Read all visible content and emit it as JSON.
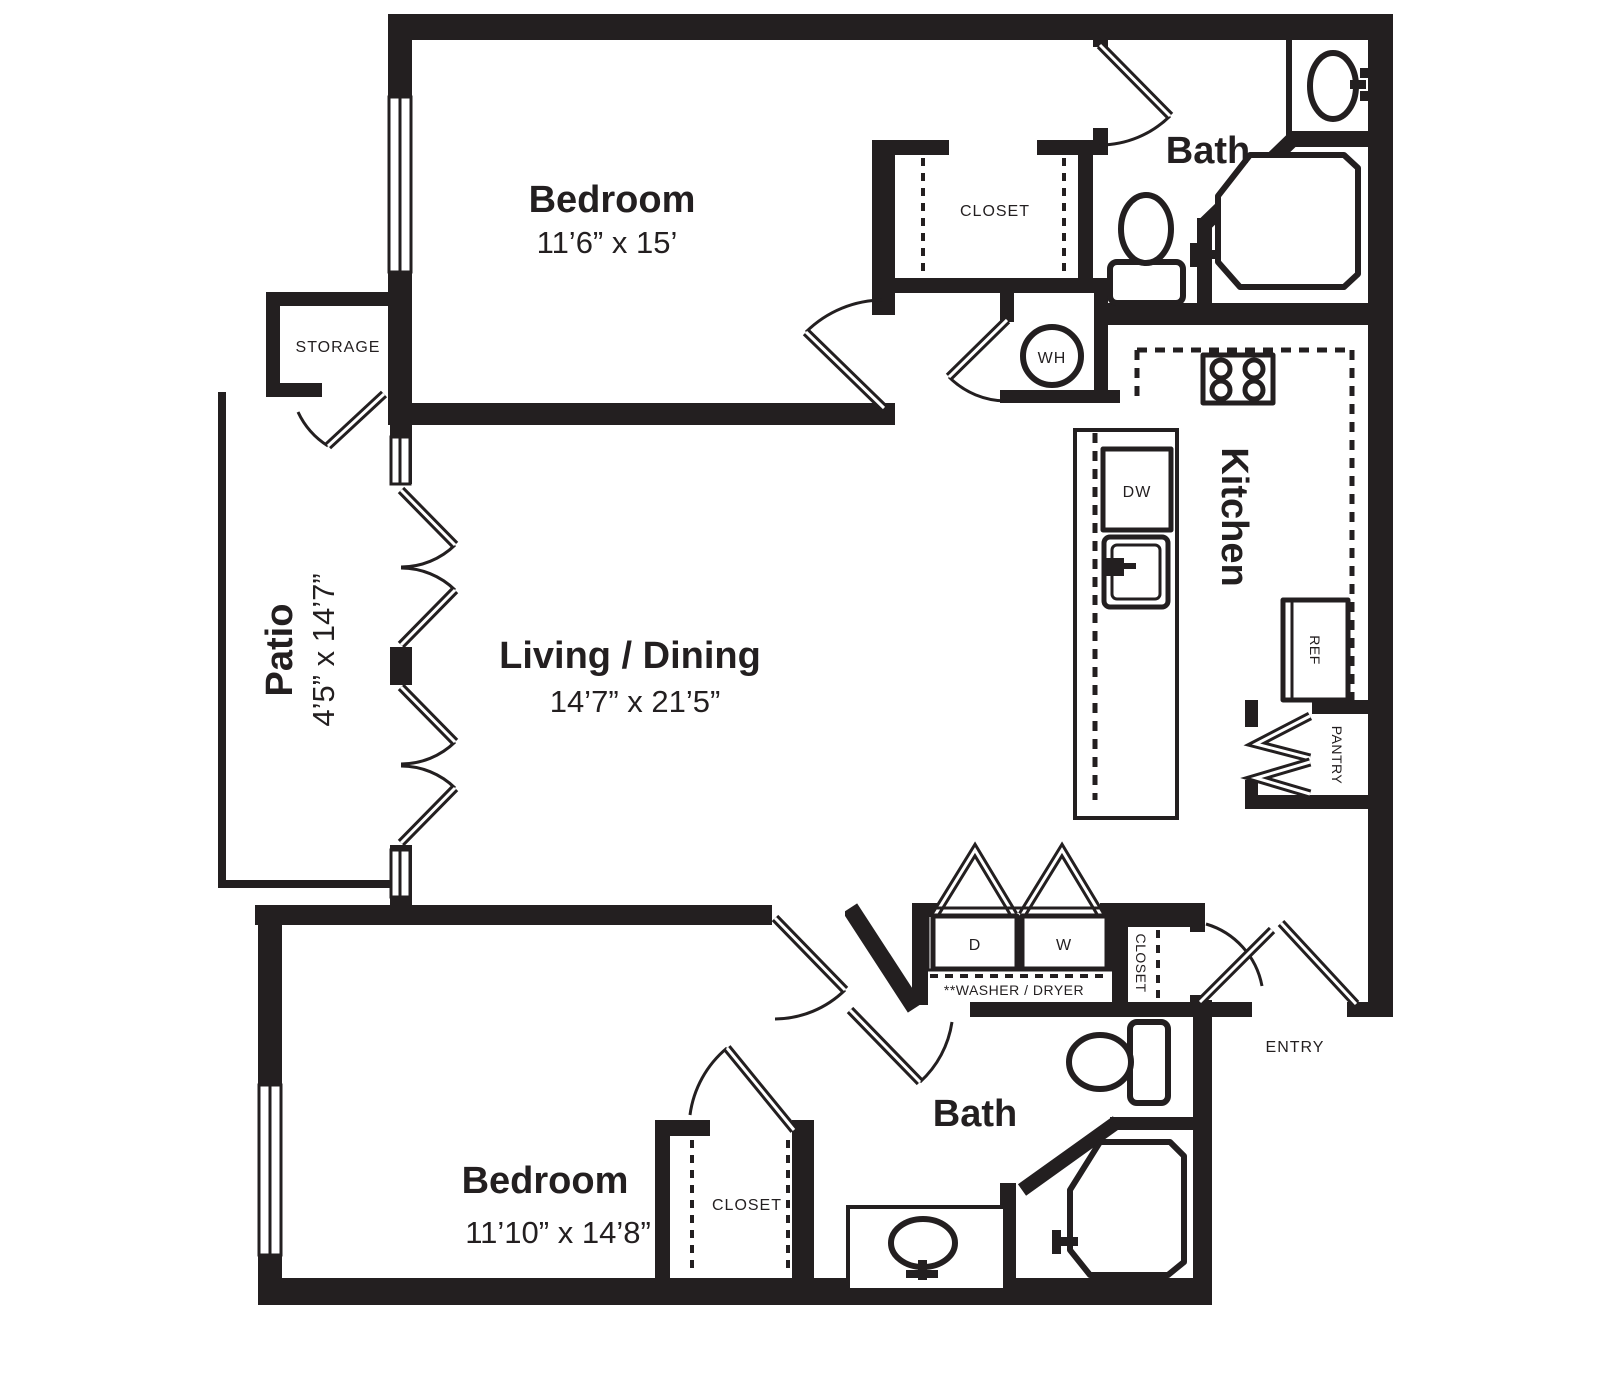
{
  "floorplan": {
    "title": "Two bedroom two bath apartment floor plan",
    "colors": {
      "line": "#231f20",
      "background": "#ffffff"
    },
    "rooms": {
      "bedroom1": {
        "name": "Bedroom",
        "dims": "11’6” x 15’"
      },
      "bedroom2": {
        "name": "Bedroom",
        "dims": "11’10” x 14’8”"
      },
      "living": {
        "name": "Living / Dining",
        "dims": "14’7” x 21’5”"
      },
      "patio": {
        "name": "Patio",
        "dims": "4’5” x 14’7”"
      },
      "kitchen": {
        "name": "Kitchen"
      },
      "bath1": {
        "name": "Bath"
      },
      "bath2": {
        "name": "Bath"
      },
      "storage": {
        "name": "STORAGE"
      },
      "closet1": {
        "name": "CLOSET"
      },
      "closet2": {
        "name": "CLOSET"
      },
      "entry_closet": {
        "name": "CLOSET"
      },
      "pantry": {
        "name": "PANTRY"
      },
      "entry": {
        "name": "ENTRY"
      }
    },
    "appliances": {
      "water_heater": "WH",
      "dishwasher": "DW",
      "refrigerator": "REF",
      "dryer": "D",
      "washer": "W",
      "washer_dryer_note": "**WASHER / DRYER"
    }
  }
}
